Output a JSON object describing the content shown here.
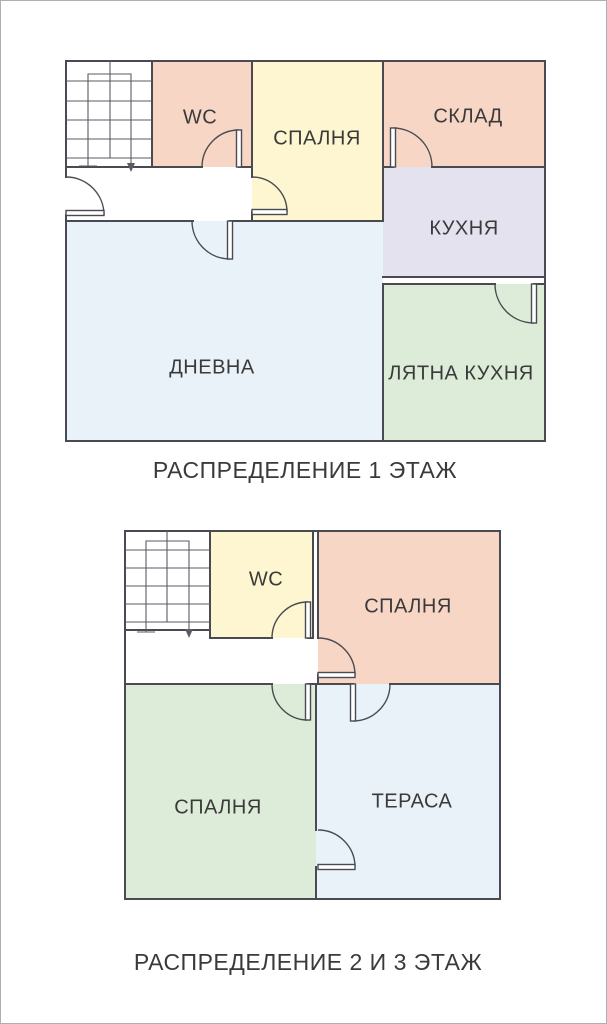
{
  "palette": {
    "wall": "#4a4b52",
    "stair_line": "#5a5b63",
    "label_text": "#3a3a3a",
    "room_pink": "#f7d6c6",
    "room_yellow": "#fdf6d0",
    "room_lavender": "#e4e2ee",
    "room_green": "#ddecd8",
    "room_blue": "#e9f2f9",
    "room_white": "#ffffff",
    "frame_border": "#b0b0b0"
  },
  "floor1": {
    "caption": "РАСПРЕДЕЛЕНИЕ 1 ЭТАЖ",
    "rooms": {
      "wc": "WC",
      "bedroom": "СПАЛНЯ",
      "storage": "СКЛАД",
      "kitchen": "КУХНЯ",
      "living_room": "ДНЕВНА",
      "summer_kitchen": "ЛЯТНА КУХНЯ"
    }
  },
  "floor23": {
    "caption": "РАСПРЕДЕЛЕНИЕ 2 И 3 ЭТАЖ",
    "rooms": {
      "wc": "WC",
      "bedroom_upper": "СПАЛНЯ",
      "bedroom_lower": "СПАЛНЯ",
      "terrace": "ТЕРАСА"
    }
  }
}
